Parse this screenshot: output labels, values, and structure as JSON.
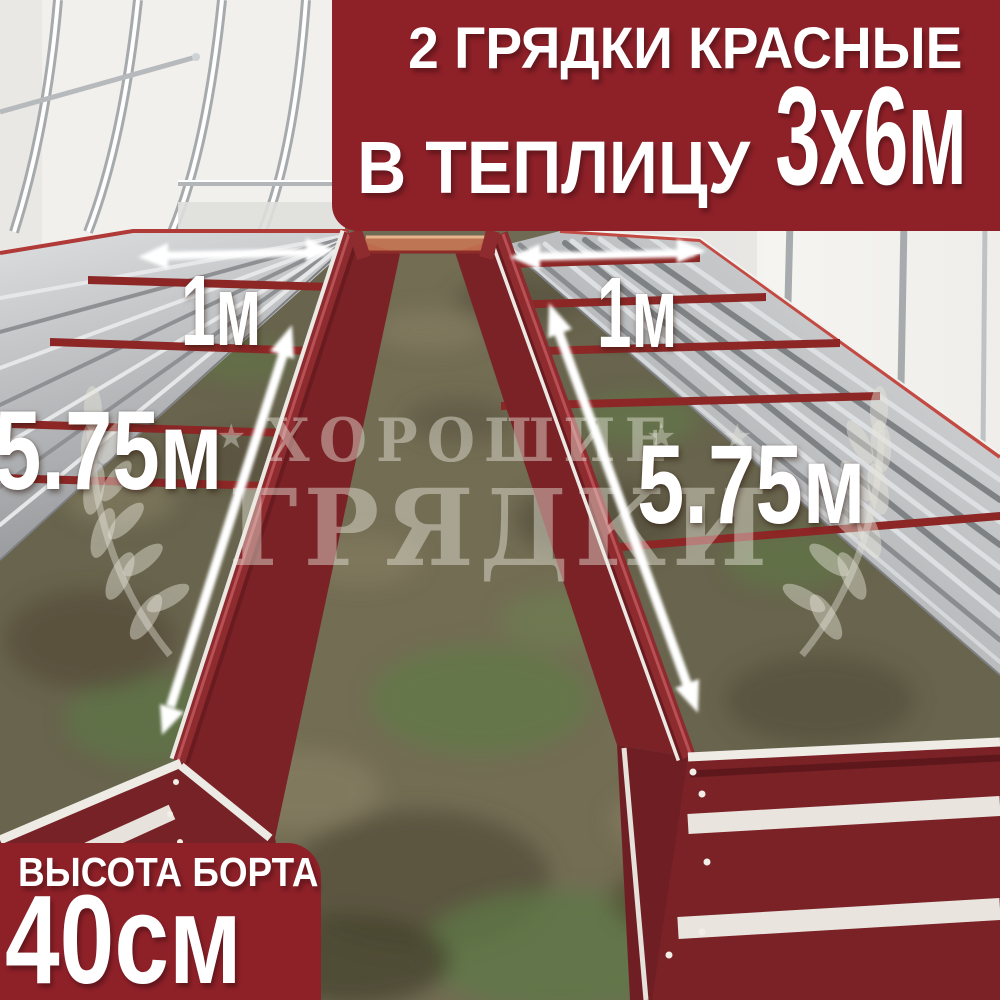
{
  "top_banner": {
    "line1": "2 ГРЯДКИ КРАСНЫЕ",
    "line2_prefix": "В ТЕПЛИЦУ",
    "line2_size": "3х6м"
  },
  "bottom_banner": {
    "label": "ВЫСОТА БОРТА",
    "value": "40см"
  },
  "measurements": {
    "left_bed_width": "1м",
    "right_bed_width": "1м",
    "left_bed_length": "5.75м",
    "right_bed_length": "5.75м"
  },
  "watermark": {
    "line1": "ХОРОШИЕ",
    "line2": "ГРЯДКИ",
    "star": "★"
  },
  "colors": {
    "banner_red": "#8E2028",
    "bed_red": "#7A2226",
    "rail_red": "#8E2B2F",
    "cross_tie_red": "#8C2726",
    "back_tie_orange": "#CC7755",
    "silver_light": "#D8DADC",
    "silver_dark": "#97999C",
    "wall_white": "#F1F0ED",
    "ground_olive": "#6F6A53",
    "grass_green": "#5E7846",
    "overlay_text": "#FFFFFF"
  }
}
